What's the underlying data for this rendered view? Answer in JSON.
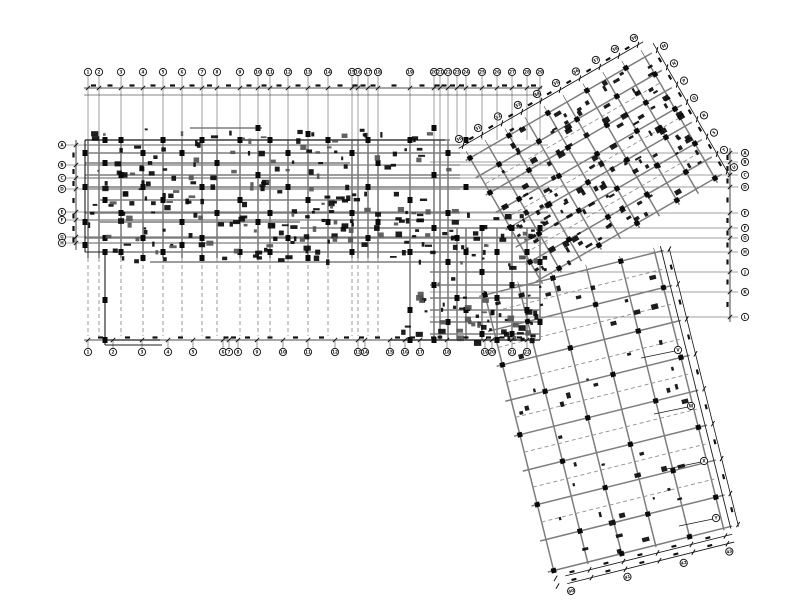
{
  "drawing": {
    "title": "structural-framing-plan",
    "colors": {
      "ink": "#1c1c1c",
      "grid": "#2a2a2a",
      "beam": "#7d7d7d",
      "dashed": "#8f8f8f",
      "column": "#0a0a0a",
      "dim": "#111111",
      "paper": "#ffffff"
    },
    "bubble": {
      "r": 3.6,
      "font": 4.2
    },
    "top_axis": {
      "y_bubble": 72,
      "y_dim": 88,
      "y_dim2": 95,
      "xs": [
        88,
        99,
        121,
        143,
        163,
        182,
        202,
        217,
        240,
        258,
        270,
        288,
        308,
        328,
        352,
        358,
        368,
        378,
        410,
        434,
        440,
        448,
        457,
        466,
        482,
        497,
        512,
        527,
        540
      ],
      "labels": [
        "1",
        "2",
        "3",
        "4",
        "5",
        "6",
        "7",
        "8",
        "9",
        "10",
        "11",
        "12",
        "13",
        "14",
        "15",
        "16",
        "17",
        "18",
        "19",
        "20",
        "21",
        "22",
        "23",
        "24",
        "25",
        "26",
        "27",
        "28",
        "29"
      ]
    },
    "bottom_axis": {
      "y_bubble": 352,
      "y_dim": 340,
      "xs": [
        88,
        113,
        142,
        168,
        193,
        223,
        229,
        238,
        257,
        283,
        308,
        335,
        358,
        365,
        390,
        405,
        420,
        447,
        485,
        492,
        512,
        527
      ],
      "labels": [
        "1",
        "2",
        "3",
        "4",
        "5",
        "6",
        "7",
        "8",
        "9",
        "10",
        "11",
        "12",
        "13",
        "14",
        "15",
        "16",
        "17",
        "18",
        "19",
        "20",
        "21",
        "22"
      ]
    },
    "left_axis": {
      "x_bubble": 62,
      "x_dim": 76,
      "ys": [
        145,
        165,
        178,
        189,
        212,
        220,
        237,
        243
      ],
      "labels": [
        "A",
        "B",
        "C",
        "D",
        "E",
        "F",
        "G",
        "H"
      ]
    },
    "right_axis": {
      "x_bubble": 745,
      "x_dim": 730,
      "x_line_start": 430,
      "x_line_end": 738,
      "ys": [
        153,
        162,
        175,
        187,
        213,
        228,
        238,
        252,
        272,
        292,
        317
      ],
      "labels": [
        "A",
        "B",
        "C",
        "D",
        "E",
        "F",
        "G",
        "H",
        "J",
        "K",
        "L"
      ]
    },
    "outline": [
      [
        85,
        140,
        85,
        252
      ],
      [
        85,
        252,
        105,
        252
      ],
      [
        105,
        252,
        105,
        345
      ],
      [
        105,
        345,
        162,
        345
      ],
      [
        85,
        140,
        445,
        140
      ],
      [
        390,
        340,
        540,
        340
      ]
    ],
    "beams_h": [
      [
        140,
        85,
        450
      ],
      [
        128,
        190,
        262
      ],
      [
        153,
        85,
        460
      ],
      [
        163,
        85,
        350
      ],
      [
        175,
        85,
        460
      ],
      [
        187,
        85,
        540
      ],
      [
        200,
        100,
        350
      ],
      [
        213,
        85,
        460
      ],
      [
        222,
        100,
        300
      ],
      [
        228,
        300,
        540
      ],
      [
        238,
        85,
        540
      ],
      [
        252,
        105,
        460
      ],
      [
        262,
        150,
        540
      ],
      [
        272,
        430,
        540
      ],
      [
        285,
        430,
        540
      ],
      [
        298,
        430,
        540
      ],
      [
        310,
        430,
        540
      ],
      [
        322,
        430,
        540
      ],
      [
        334,
        430,
        540
      ],
      [
        340,
        390,
        540
      ],
      [
        340,
        105,
        160
      ]
    ],
    "beam_v_rules": {
      "tall_from": 410,
      "very_tall_from": 457,
      "short_end": 258,
      "tall_end": 340,
      "very_tall_start": 228,
      "top": 140
    },
    "dashed_v": {
      "y0": 258,
      "y1": 336,
      "max_x": 395
    },
    "columns": [
      [
        85,
        153
      ],
      [
        85,
        187
      ],
      [
        85,
        222
      ],
      [
        85,
        245
      ],
      [
        105,
        140
      ],
      [
        105,
        163
      ],
      [
        105,
        200
      ],
      [
        105,
        238
      ],
      [
        105,
        252
      ],
      [
        105,
        300
      ],
      [
        105,
        340
      ],
      [
        121,
        140
      ],
      [
        121,
        175
      ],
      [
        121,
        213
      ],
      [
        121,
        252
      ],
      [
        143,
        153
      ],
      [
        143,
        187
      ],
      [
        143,
        238
      ],
      [
        143,
        258
      ],
      [
        163,
        140
      ],
      [
        163,
        200
      ],
      [
        163,
        252
      ],
      [
        182,
        153
      ],
      [
        182,
        222
      ],
      [
        182,
        245
      ],
      [
        202,
        140
      ],
      [
        202,
        187
      ],
      [
        202,
        238
      ],
      [
        202,
        258
      ],
      [
        217,
        163
      ],
      [
        217,
        213
      ],
      [
        240,
        140
      ],
      [
        240,
        200
      ],
      [
        240,
        252
      ],
      [
        258,
        128
      ],
      [
        258,
        175
      ],
      [
        258,
        222
      ],
      [
        270,
        140
      ],
      [
        270,
        213
      ],
      [
        270,
        252
      ],
      [
        288,
        153
      ],
      [
        288,
        187
      ],
      [
        288,
        238
      ],
      [
        308,
        134
      ],
      [
        308,
        200
      ],
      [
        308,
        258
      ],
      [
        328,
        140
      ],
      [
        328,
        222
      ],
      [
        352,
        153
      ],
      [
        352,
        213
      ],
      [
        352,
        252
      ],
      [
        368,
        140
      ],
      [
        368,
        187
      ],
      [
        368,
        238
      ],
      [
        378,
        163
      ],
      [
        378,
        222
      ],
      [
        410,
        140
      ],
      [
        410,
        200
      ],
      [
        410,
        252
      ],
      [
        410,
        310
      ],
      [
        410,
        340
      ],
      [
        434,
        128
      ],
      [
        434,
        175
      ],
      [
        434,
        228
      ],
      [
        434,
        285
      ],
      [
        434,
        340
      ],
      [
        448,
        153
      ],
      [
        448,
        213
      ],
      [
        448,
        262
      ],
      [
        448,
        322
      ],
      [
        457,
        238
      ],
      [
        457,
        298
      ],
      [
        466,
        140
      ],
      [
        466,
        187
      ],
      [
        466,
        252
      ],
      [
        466,
        310
      ],
      [
        482,
        228
      ],
      [
        482,
        272
      ],
      [
        482,
        334
      ],
      [
        497,
        252
      ],
      [
        497,
        298
      ],
      [
        497,
        340
      ],
      [
        512,
        228
      ],
      [
        512,
        285
      ],
      [
        512,
        334
      ],
      [
        527,
        252
      ],
      [
        527,
        310
      ],
      [
        540,
        228
      ],
      [
        540,
        262
      ],
      [
        540,
        322
      ]
    ],
    "scatter": [
      {
        "x0": 88,
        "y0": 128,
        "x1": 420,
        "y1": 260,
        "n": 150,
        "seed": 7
      },
      {
        "x0": 400,
        "y0": 210,
        "x1": 545,
        "y1": 342,
        "n": 80,
        "seed": 13
      }
    ],
    "label_ticks": [
      {
        "x0": 90,
        "y0": 130,
        "x1": 460,
        "y1": 258,
        "n": 60,
        "seed": 21
      },
      {
        "x0": 410,
        "y0": 230,
        "x1": 540,
        "y1": 340,
        "n": 25,
        "seed": 33
      }
    ],
    "upper_block": {
      "tx": 470,
      "ty": 158,
      "angle": -30,
      "cols": [
        0,
        22,
        45,
        68,
        90,
        112,
        135,
        158,
        180,
        202
      ],
      "rows": [
        0,
        20,
        40,
        60,
        80,
        100,
        120,
        140
      ],
      "col_ext": [
        -8,
        145
      ],
      "row_ext": [
        -5,
        210
      ],
      "dashed_rows": [
        30,
        70,
        110
      ],
      "dim_top_y": -14,
      "dim_top_ext": [
        -5,
        208
      ],
      "bubble_top_y": -22,
      "dim_right_x": 216,
      "dim_right_ext": [
        -8,
        145
      ],
      "bubble_right_x": 224,
      "top_labels": [
        "30",
        "31",
        "32",
        "33",
        "34",
        "35",
        "36",
        "37",
        "38",
        "39"
      ],
      "right_labels": [
        "M",
        "N",
        "P",
        "Q",
        "R",
        "S",
        "T",
        "U"
      ],
      "scatter": {
        "x0": 0,
        "y0": -5,
        "x1": 205,
        "y1": 140,
        "n": 130,
        "seed": 41
      }
    },
    "lower_block": {
      "tx": 485,
      "ty": 295,
      "angle": -14,
      "cols": [
        0,
        35,
        70,
        105,
        140,
        175
      ],
      "rows": [
        0,
        36,
        72,
        108,
        144,
        180,
        216,
        252,
        284
      ],
      "col_ext": [
        -5,
        286
      ],
      "row_ext": [
        -6,
        184
      ],
      "dashed_rows": [
        18,
        54,
        90,
        126,
        162,
        198,
        234
      ],
      "edge_right_x": 182,
      "dim_right_x": 190,
      "dim_right_ext": [
        0,
        286
      ],
      "dim_bottom_ys": [
        292,
        300
      ],
      "dim_bottom_ext": [
        10,
        182
      ],
      "bubble_bottom_y": 308,
      "bottom_xs": [
        12,
        70,
        128,
        175
      ],
      "bottom_labels": [
        "40",
        "41",
        "42",
        "43"
      ],
      "scatter": {
        "x0": 0,
        "y0": 0,
        "x1": 172,
        "y1": 280,
        "n": 48,
        "seed": 55
      }
    },
    "leader_bubbles": [
      {
        "x": 678,
        "y": 350,
        "lx": 641,
        "ly": 358,
        "label": "V"
      },
      {
        "x": 691,
        "y": 406,
        "lx": 654,
        "ly": 414,
        "label": "W"
      },
      {
        "x": 704,
        "y": 461,
        "lx": 667,
        "ly": 469,
        "label": "X"
      },
      {
        "x": 716,
        "y": 518,
        "lx": 679,
        "ly": 526,
        "label": "Y"
      }
    ]
  }
}
